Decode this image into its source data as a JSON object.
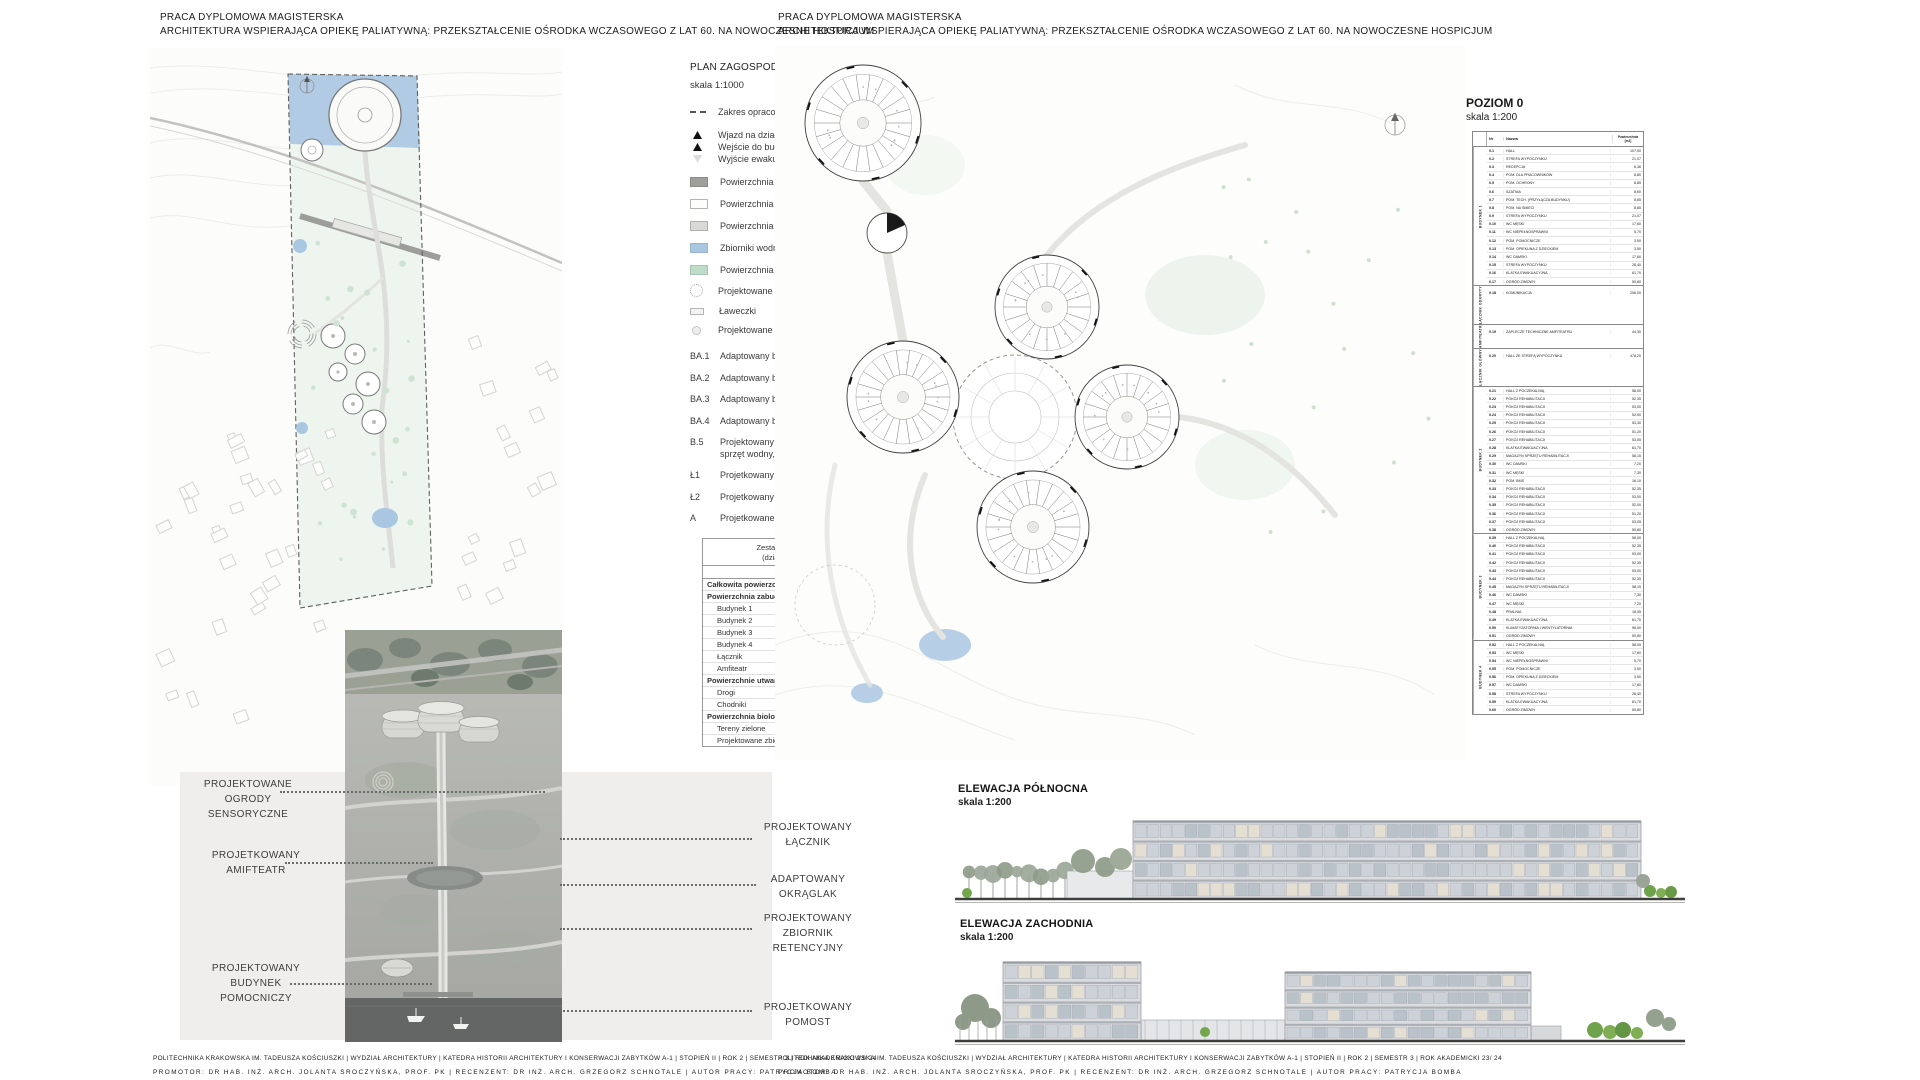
{
  "meta": {
    "project_title_line1": "PRACA DYPLOMOWA MAGISTERSKA",
    "project_title_line2": "ARCHITEKTURA WSPIERAJĄCA OPIEKĘ PALIATYWNĄ: PRZEKSZTAŁCENIE OŚRODKA WCZASOWEGO Z LAT 60. NA NOWOCZESNE HOSPICJUM",
    "footer_line1": "POLITECHNIKA KRAKOWSKA IM. TADEUSZA KOŚCIUSZKI | WYDZIAŁ ARCHITEKTURY | KATEDRA HISTORII ARCHITEKTURY I KONSERWACJI ZABYTKÓW A-1 | STOPIEŃ II | ROK 2 | SEMESTR 3 | ROK AKADEMICKI 23/ 24",
    "footer_line2": "PROMOTOR: DR HAB. INŻ. ARCH. JOLANTA SROCZYŃSKA, PROF. PK | RECENZENT: DR INŻ. ARCH. GRZEGORZ SCHNOTALE | AUTOR PRACY: PATRYCJA BOMBA"
  },
  "colors": {
    "water": "#aac7e2",
    "bio_green": "#bfdcc9",
    "paved_road": "#9f9f9c",
    "panel_gray": "#efeeec"
  },
  "site_plan": {
    "title": "PLAN ZAGOSPODAROWANIA TERENU",
    "scale": "skala 1:1000",
    "legend_items": [
      {
        "sw": "dash",
        "rc": "gap",
        "label": "Zakres opracowania"
      },
      {
        "sw": "tri",
        "rc": "tight",
        "label": "Wjazd na działkę"
      },
      {
        "sw": "tri",
        "rc": "tight",
        "label": "Wejście do budynku"
      },
      {
        "sw": "trio",
        "rc": "gap",
        "label": "Wyjście ewakuacyjne"
      },
      {
        "sw": "road",
        "rc": "big",
        "label": "Powierzchnia utwardzona - jezdnia"
      },
      {
        "sw": "path1",
        "rc": "big",
        "label": "Powierzchnia utwardzona  - ciąg pieszy - typ I"
      },
      {
        "sw": "path2",
        "rc": "big",
        "label": "Powierzchnia utwardzona - ciąg pieszy - typ II"
      },
      {
        "sw": "water",
        "rc": "big",
        "label": "Zbiorniki wodny"
      },
      {
        "sw": "green",
        "rc": "",
        "label": "Powierzchnia biologicznie czynna"
      },
      {
        "sw": "garden",
        "rc": "",
        "label": "Projektowane ogrody sensoryczne"
      },
      {
        "sw": "bench",
        "rc": "",
        "label": "Ławeczki"
      },
      {
        "sw": "light",
        "rc": "",
        "label": "Projektowane oświetlenie"
      }
    ],
    "legend_codes": [
      {
        "code": "BA.1",
        "label": "Adaptowany budynek 1"
      },
      {
        "code": "BA.2",
        "label": "Adaptowany budynek 2"
      },
      {
        "code": "BA.3",
        "label": "Adaptowany budynek 3"
      },
      {
        "code": "BA.4",
        "label": "Adaptowany budynek 4"
      },
      {
        "code": "B.5",
        "label": "Projektowany budynek pomocniczy (pomieszczenie na sprzęt wodny, restauracja, szatnie)"
      },
      {
        "code": "Ł1",
        "label": "Projetkowany łącznik 1"
      },
      {
        "code": "Ł2",
        "label": "Projetkowany łącznik 2"
      },
      {
        "code": "A",
        "label": "Projetkowane Atrium"
      }
    ]
  },
  "area_table": {
    "title": "Zestawienie powierzchni terenu",
    "subtitle": "(działki ewidencyjnej nr 116)",
    "col_m2": "[m2]",
    "col_pct": "[%]",
    "rows": [
      {
        "l": "Całkowita powierzchnia inwestycji",
        "m2": "78 500,0",
        "p": "100,00%",
        "cls": "h"
      },
      {
        "l": "Powierzchnia zabudowy",
        "m2": "1 649,3",
        "p": "2,10%",
        "cls": "h"
      },
      {
        "l": "Budynek 1",
        "m2": "423,6",
        "p": "0,54%",
        "cls": "s"
      },
      {
        "l": "Budynek 2",
        "m2": "423,6",
        "p": "0,54%",
        "cls": "s"
      },
      {
        "l": "Budynek 3",
        "m2": "423,6",
        "p": "0,54%",
        "cls": "s"
      },
      {
        "l": "Budynek 4",
        "m2": "423,6",
        "p": "0,54%",
        "cls": "s"
      },
      {
        "l": "Łącznik",
        "m2": "236,0",
        "p": "0,30%",
        "cls": "s"
      },
      {
        "l": "Amfiteatr",
        "m2": "142,6",
        "p": "0,18%",
        "cls": "s"
      },
      {
        "l": "Powierzchnie utwardzone",
        "m2": "7 275,5",
        "p": "9,27%",
        "cls": "h"
      },
      {
        "l": "Drogi",
        "m2": "4 862,0",
        "p": "6,19%",
        "cls": "s"
      },
      {
        "l": "Chodniki",
        "m2": "2 413,5",
        "p": "3,07%",
        "cls": "s"
      },
      {
        "l": "Powierzchnia biologicznie czynna",
        "m2": "69575,19",
        "p": "88,63%",
        "cls": "h"
      },
      {
        "l": "Tereny zielone",
        "m2": "68 407,1",
        "p": "87,14%",
        "cls": "s"
      },
      {
        "l": "Projektowane zbiorniki wodne",
        "m2": "1 168,1",
        "p": "0,00%",
        "cls": "s"
      }
    ]
  },
  "callouts": [
    {
      "text": "PROJEKTOWANE\nOGRODY\nSENSORYCZNE"
    },
    {
      "text": "PROJETKOWANY\nAMIFTEATR"
    },
    {
      "text": "PROJEKTOWANY\nBUDYNEK\nPOMOCNICZY"
    },
    {
      "text": "PROJEKTOWANY\nŁĄCZNIK"
    },
    {
      "text": "ADAPTOWANY\nOKRĄGLAK"
    },
    {
      "text": "PROJEKTOWANY\nZBIORNIK\nRETENCYJNY"
    },
    {
      "text": "PROJETKOWANY\nPOMOST"
    }
  ],
  "floor_plan": {
    "title": "POZIOM 0",
    "scale": "skala 1:200"
  },
  "room_table": {
    "col_nr": "Nr",
    "col_name": "Nazwa",
    "col_area": "Powierzchnia\n[m2]",
    "groups": [
      {
        "name": "BUDYNEK 1",
        "rows": [
          {
            "nr": "0.1",
            "name": "HALL",
            "area": "107,00"
          },
          {
            "nr": "0.2",
            "name": "STREFA WYPOCZYNKU",
            "area": "21,07"
          },
          {
            "nr": "0.3",
            "name": "RECEPCJA",
            "area": "6,36"
          },
          {
            "nr": "0.4",
            "name": "POM. DLA PRACOWNIKÓW",
            "area": "8,80"
          },
          {
            "nr": "0.5",
            "name": "POM. OCHRONY",
            "area": "8,85"
          },
          {
            "nr": "0.6",
            "name": "SZATNIA",
            "area": "8,60"
          },
          {
            "nr": "0.7",
            "name": "POM. TECH. (PRZYŁĄCZA BUDYNKU)",
            "area": "8,85"
          },
          {
            "nr": "0.8",
            "name": "POM. NA ŚMIECI",
            "area": "8,85"
          },
          {
            "nr": "0.9",
            "name": "STREFA WYPOCZYNKU",
            "area": "21,07"
          },
          {
            "nr": "0.10",
            "name": "WC MĘSKI",
            "area": "17,60"
          },
          {
            "nr": "0.11",
            "name": "WC NIEPEŁNOSPRAWNI",
            "area": "5,70"
          },
          {
            "nr": "0.12",
            "name": "POM. POMOCNICZE",
            "area": "3,50"
          },
          {
            "nr": "0.13",
            "name": "POM. OPIEKUNA Z DZIECKIEM",
            "area": "3,50"
          },
          {
            "nr": "0.14",
            "name": "WC DAMSKI",
            "area": "17,60"
          },
          {
            "nr": "0.15",
            "name": "STREFA WYPOCZYNKU",
            "area": "26,40"
          },
          {
            "nr": "0.16",
            "name": "KLATKA EWAKUACYJNA",
            "area": "61,70"
          },
          {
            "nr": "0.17",
            "name": "OGRÓD ZIMOWY",
            "area": "50,80"
          }
        ]
      },
      {
        "name": "ŁĄCZNIK ODKRYTY",
        "rows": [
          {
            "nr": "0.18",
            "name": "KOMUNIKACJA",
            "area": "206,00",
            "cls": "tall"
          }
        ]
      },
      {
        "name": "AMFITEATR",
        "rows": [
          {
            "nr": "0.19",
            "name": "ZAPLECZE TECHNICZNE AMFITEATRU",
            "area": "44,30",
            "cls": "tall"
          }
        ]
      },
      {
        "name": "ŁĄCZNIK GŁÓWNY",
        "rows": [
          {
            "nr": "0.20",
            "name": "HALL ZE STREFĄ WYPOCZYNKU",
            "area": "478,20",
            "cls": "tall"
          }
        ]
      },
      {
        "name": "BUDYNEK 2",
        "rows": [
          {
            "nr": "0.21",
            "name": "HALL Z POCZEKALNIĄ",
            "area": "58,00"
          },
          {
            "nr": "0.22",
            "name": "POKÓJ REHABILITACJI",
            "area": "52,35"
          },
          {
            "nr": "0.23",
            "name": "POKÓJ REHABILITACJI",
            "area": "53,00"
          },
          {
            "nr": "0.24",
            "name": "POKÓJ REHABILITACJI",
            "area": "52,00"
          },
          {
            "nr": "0.25",
            "name": "POKÓJ REHABILITACJI",
            "area": "53,30"
          },
          {
            "nr": "0.26",
            "name": "POKÓJ REHABILITACJI",
            "area": "51,20"
          },
          {
            "nr": "0.27",
            "name": "POKÓJ REHABILITACJI",
            "area": "53,05"
          },
          {
            "nr": "0.28",
            "name": "KLATKA EWAKUACYJNA",
            "area": "61,70"
          },
          {
            "nr": "0.29",
            "name": "MAGAZYN SPRZĘTU REHABILITACJI",
            "area": "58,15"
          },
          {
            "nr": "0.30",
            "name": "WC DAMSKI",
            "area": "7,20"
          },
          {
            "nr": "0.31",
            "name": "WC MĘSKI",
            "area": "7,30"
          },
          {
            "nr": "0.32",
            "name": "POM. BMS",
            "area": "16,10"
          },
          {
            "nr": "0.33",
            "name": "POKÓJ REHABILITACJI",
            "area": "52,35"
          },
          {
            "nr": "0.34",
            "name": "POKÓJ REHABILITACJI",
            "area": "53,00"
          },
          {
            "nr": "0.35",
            "name": "POKÓJ REHABILITACJI",
            "area": "52,00"
          },
          {
            "nr": "0.36",
            "name": "POKÓJ REHABILITACJI",
            "area": "51,20"
          },
          {
            "nr": "0.37",
            "name": "POKÓJ REHABILITACJI",
            "area": "53,05"
          },
          {
            "nr": "0.38",
            "name": "OGRÓD ZIMOWY",
            "area": "50,80"
          }
        ]
      },
      {
        "name": "BUDYNEK 3",
        "rows": [
          {
            "nr": "0.39",
            "name": "HALL Z POCZEKALNIĄ",
            "area": "58,00"
          },
          {
            "nr": "0.40",
            "name": "POKÓJ REHABILITACJI",
            "area": "52,35"
          },
          {
            "nr": "0.41",
            "name": "POKÓJ REHABILITACJI",
            "area": "53,00"
          },
          {
            "nr": "0.42",
            "name": "POKÓJ REHABILITACJI",
            "area": "52,35"
          },
          {
            "nr": "0.43",
            "name": "POKÓJ REHABILITACJI",
            "area": "53,00"
          },
          {
            "nr": "0.44",
            "name": "POKÓJ REHABILITACJI",
            "area": "52,35"
          },
          {
            "nr": "0.45",
            "name": "MAGAZYN SPRZĘTU REHABILITACJI",
            "area": "58,15"
          },
          {
            "nr": "0.46",
            "name": "WC DAMSKI",
            "area": "7,30"
          },
          {
            "nr": "0.47",
            "name": "WC MĘSKI",
            "area": "7,20"
          },
          {
            "nr": "0.48",
            "name": "PRALNIA",
            "area": "18,35"
          },
          {
            "nr": "0.49",
            "name": "KLATKA EWAKUACYJNA",
            "area": "61,70"
          },
          {
            "nr": "0.50",
            "name": "KLIMATYZATORNIA I WENTYLATORNIA",
            "area": "98,00"
          },
          {
            "nr": "0.51",
            "name": "OGRÓD ZIMOWY",
            "area": "50,80"
          }
        ]
      },
      {
        "name": "BUDYNEK 4",
        "rows": [
          {
            "nr": "0.52",
            "name": "HALL Z POCZEKALNIĄ",
            "area": "58,00"
          },
          {
            "nr": "0.53",
            "name": "WC MĘSKI",
            "area": "17,60"
          },
          {
            "nr": "0.54",
            "name": "WC NIEPEŁNOSPRAWNI",
            "area": "5,70"
          },
          {
            "nr": "0.55",
            "name": "POM. POMOCNICZE",
            "area": "3,50"
          },
          {
            "nr": "0.56",
            "name": "POM. OPIEKUNA Z DZIECKIEM",
            "area": "3,50"
          },
          {
            "nr": "0.57",
            "name": "WC DAMSKI",
            "area": "17,60"
          },
          {
            "nr": "0.58",
            "name": "STREFA WYPOCZYNKU",
            "area": "26,40"
          },
          {
            "nr": "0.59",
            "name": "KLATKA EWAKUACYJNA",
            "area": "61,70"
          },
          {
            "nr": "0.60",
            "name": "OGRÓD ZIMOWY",
            "area": "50,80"
          }
        ]
      }
    ]
  },
  "elevations": [
    {
      "title": "ELEWACJA PÓŁNOCNA",
      "scale": "skala 1:200"
    },
    {
      "title": "ELEWACJA ZACHODNIA",
      "scale": "skala 1:200"
    }
  ]
}
